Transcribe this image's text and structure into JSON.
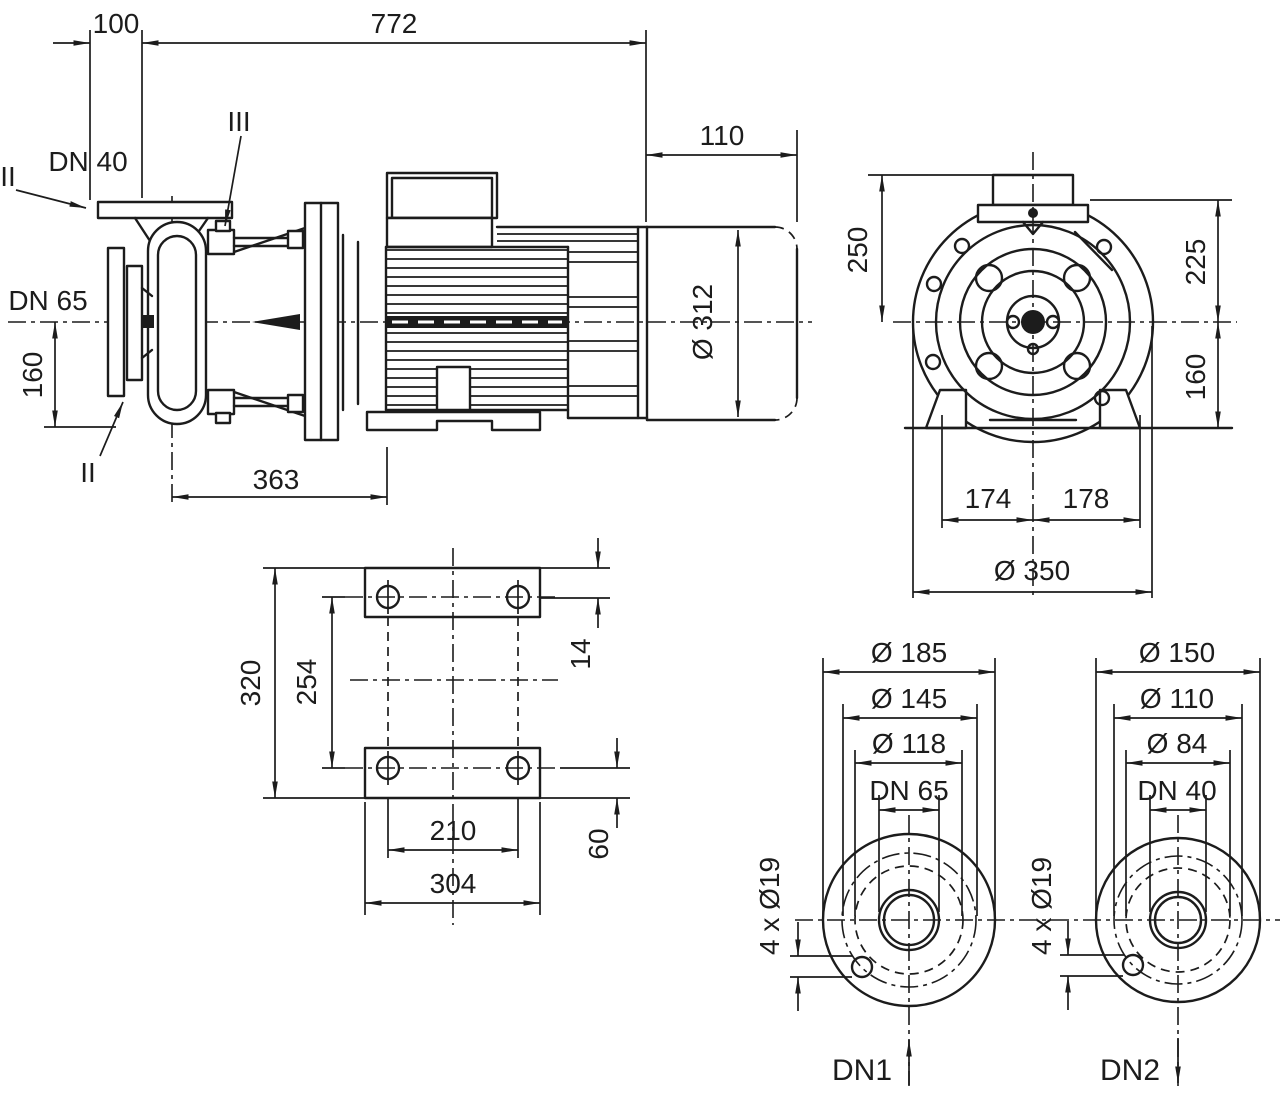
{
  "side": {
    "d100": "100",
    "d772": "772",
    "d110": "110",
    "dn40": "DN 40",
    "dn65": "DN 65",
    "sec2top": "II",
    "sec3": "III",
    "sec2bot": "II",
    "h160": "160",
    "d363": "363",
    "dia312": "Ø 312"
  },
  "front": {
    "v250": "250",
    "v225": "225",
    "v160": "160",
    "d174": "174",
    "d178": "178",
    "dia350": "Ø 350"
  },
  "plate": {
    "v320": "320",
    "v254": "254",
    "v14": "14",
    "v60": "60",
    "d210": "210",
    "d304": "304"
  },
  "flange1": {
    "dia185": "Ø 185",
    "dia145": "Ø 145",
    "dia118": "Ø 118",
    "dn": "DN 65",
    "bolts": "4 x Ø19",
    "port": "DN1"
  },
  "flange2": {
    "dia150": "Ø 150",
    "dia110": "Ø 110",
    "dia84": "Ø 84",
    "dn": "DN 40",
    "bolts": "4 x Ø19",
    "port": "DN2"
  },
  "colors": {
    "line": "#1c1c1c",
    "background": "#ffffff"
  }
}
